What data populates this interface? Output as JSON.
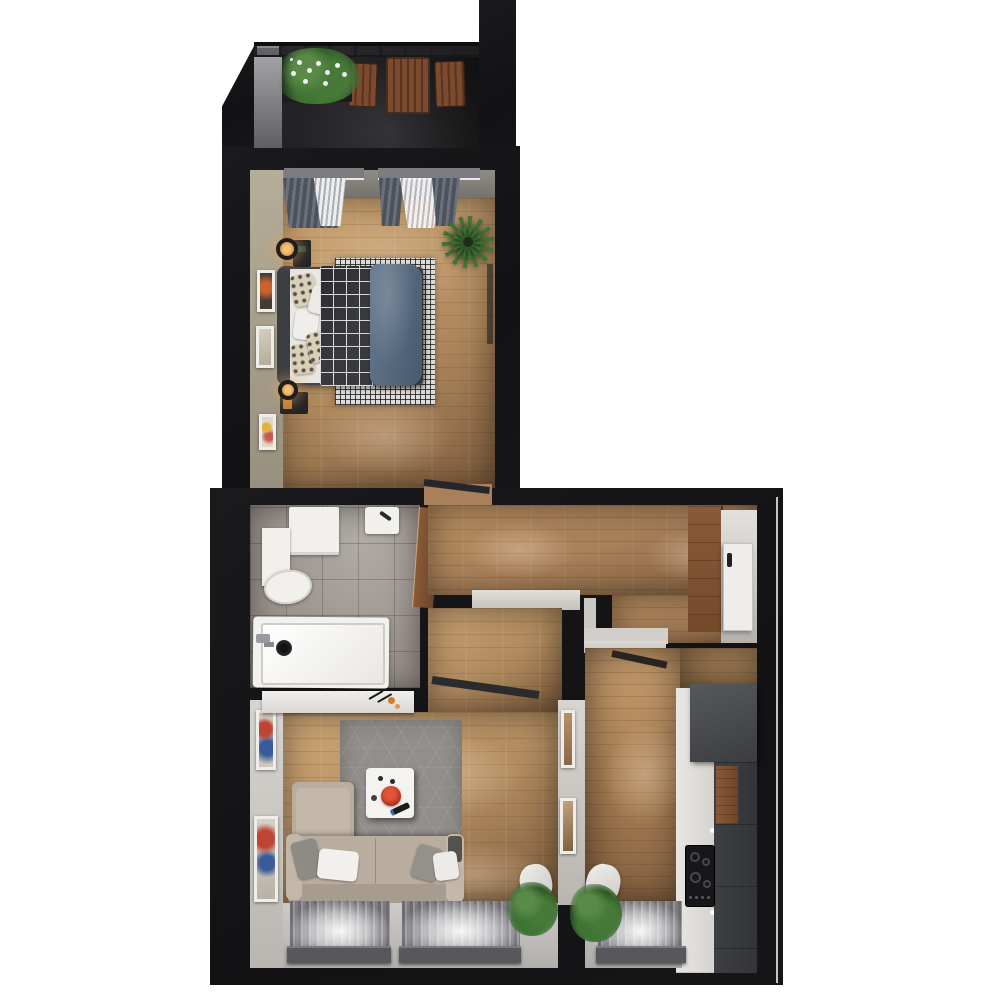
{
  "scene": {
    "description": "3D top-down architectural floor plan render of a one-bedroom apartment with balcony, on white background",
    "background": "#ffffff",
    "rooms": [
      {
        "name": "balcony",
        "position": "top",
        "furniture": [
          "railing",
          "flower-planter",
          "outdoor-table",
          "outdoor-chair-left",
          "outdoor-chair-right"
        ]
      },
      {
        "name": "bedroom",
        "position": "upper",
        "furniture": [
          "double-bed",
          "headboard",
          "white-sheets",
          "throw-pillows",
          "plaid-blanket",
          "blue-duvet",
          "checkered-rug",
          "nightstand-top",
          "table-lamp-top",
          "nightstand-bottom",
          "table-lamp-bottom",
          "window-curtains-left",
          "window-curtains-right",
          "potted-plant",
          "wall-art-1",
          "wall-art-2",
          "wall-art-3",
          "door-leaf"
        ]
      },
      {
        "name": "bathroom",
        "position": "middle-left",
        "furniture": [
          "washing-machine",
          "cistern-cabinet",
          "toilet",
          "wall-sink",
          "bathtub",
          "bathtub-drain",
          "bathtub-faucet",
          "door-leaf"
        ]
      },
      {
        "name": "hallway",
        "position": "middle-right",
        "furniture": [
          "wardrobe",
          "entrance-door",
          "doorway-sill-living-room",
          "doorway-sill-kitchen"
        ]
      },
      {
        "name": "living-room",
        "position": "bottom-left",
        "furniture": [
          "corner-sofa",
          "chaise",
          "throw-pillows",
          "coffee-table",
          "red-bowl",
          "remote-control",
          "hex-pattern-rug",
          "console-shelf",
          "decor-items",
          "wall-art-4",
          "wall-art-5",
          "wall-art-6",
          "wall-art-7",
          "window-left",
          "window-right",
          "window-sills",
          "potted-plant",
          "door-leaf"
        ]
      },
      {
        "name": "kitchen",
        "position": "bottom-right",
        "furniture": [
          "upper-dark-cabinet",
          "tall-dark-cabinet",
          "white-cabinet-run",
          "wood-cabinet-front",
          "cooktop",
          "window",
          "window-sill",
          "potted-plant",
          "door-leaf"
        ]
      }
    ]
  },
  "colors": {
    "wall": "#151517",
    "edge": "#e3e3e3",
    "balc-floor": "#232325",
    "balc-face": "#a9a9ab",
    "wood-light": "#cfa877",
    "wood-mid": "#b08a5e",
    "wood-dark": "#7e5c3d",
    "wood-hall": "#a8805a",
    "bath-floor": "#9a938c",
    "white-fix": "#f2f0ed",
    "beige-wall": "#b6ac9a",
    "light-wall": "#d8d5d1",
    "sofa": "#b8ad9f",
    "sofa-light": "#c2b7a9",
    "sofa-dark": "#a79c8e",
    "rug-gray": "#918e8b",
    "rug-check": "#dddbd7",
    "duvet": "#5c7085",
    "plaid": "#393a3e",
    "curt-dark": "#4d535d",
    "curt-mid": "#6b717b",
    "sheer": "#f0f0f2",
    "curtain-win": "#8a8a90",
    "sill": "#58585c",
    "green": "#3f7534",
    "green-dark": "#2e5826",
    "wood-furn": "#7c4a2e",
    "door-wood": "#8a5a38",
    "red": "#c8402c",
    "glow": "#e5a354",
    "cab-dark": "#46484c",
    "cab-darker": "#3d3f42",
    "cooktop": "#17171a"
  }
}
